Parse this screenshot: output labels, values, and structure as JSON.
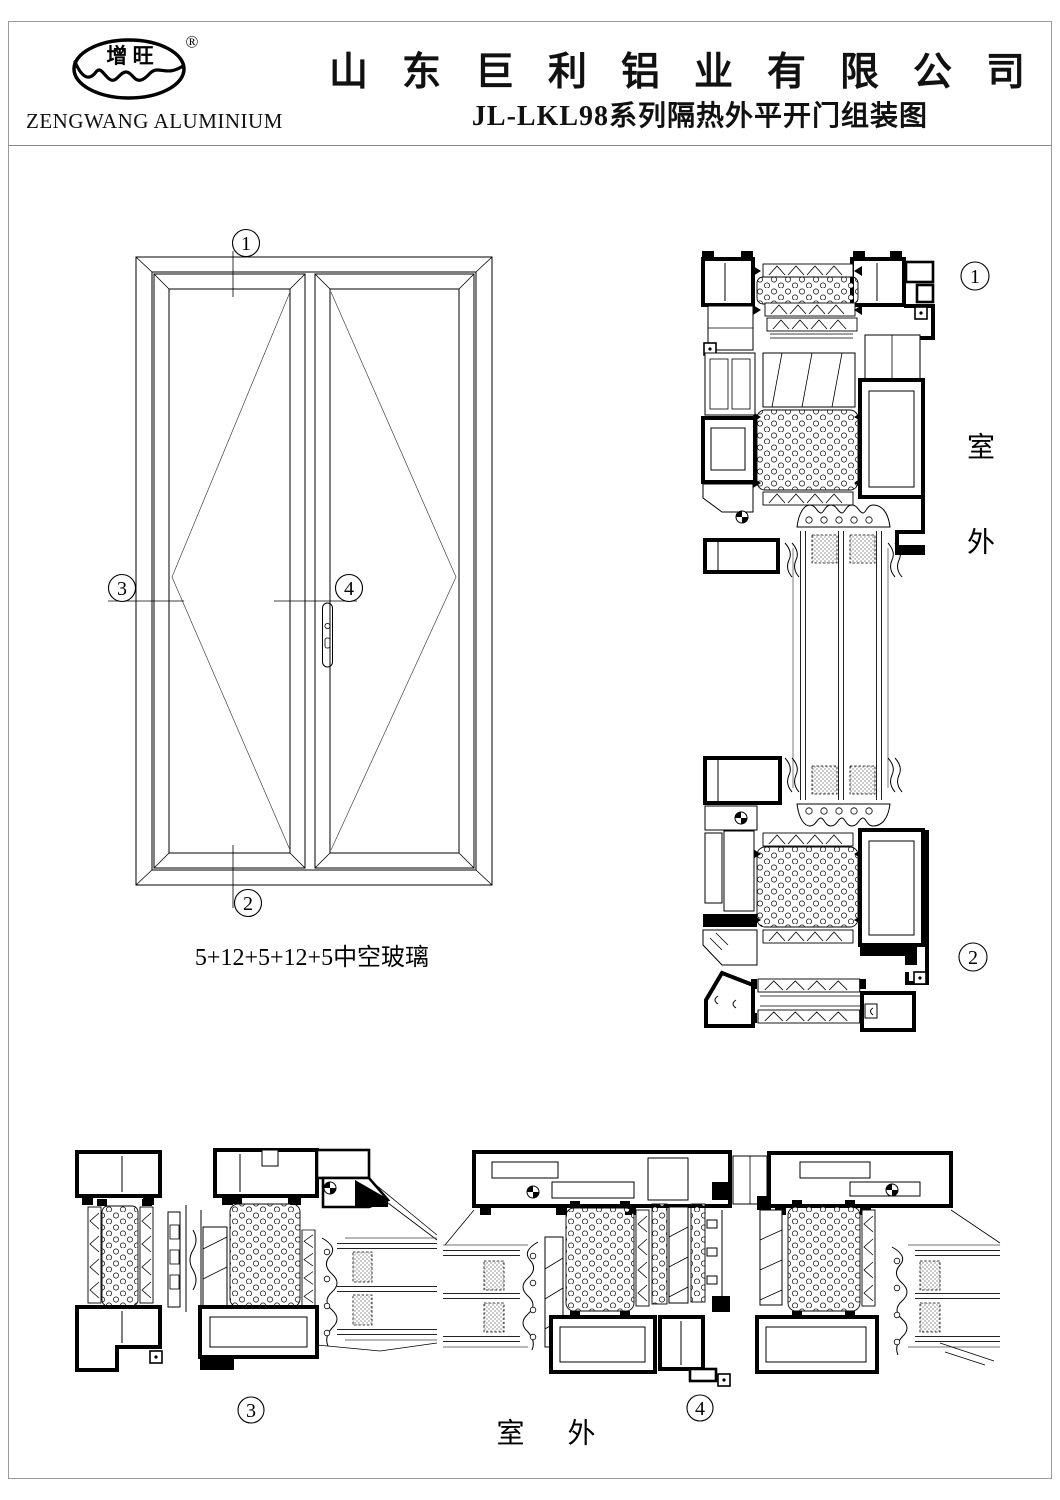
{
  "colors": {
    "ink": "#000000",
    "paper": "#ffffff",
    "page_border": "#9a9a9a"
  },
  "header": {
    "logo": {
      "oval_text": "增 旺",
      "registered_mark": "®",
      "company_en": "ZENGWANG ALUMINIUM"
    },
    "company_cn": "山东巨利铝业有限公司",
    "drawing_title": "JL-LKL98系列隔热外平开门组装图"
  },
  "elevation": {
    "glass_spec": "5+12+5+12+5中空玻璃",
    "callout_1": "1",
    "callout_2": "2",
    "callout_3": "3",
    "callout_4": "4"
  },
  "vertical_section": {
    "callout_top": "1",
    "callout_bottom": "2",
    "outdoor_char_top": "室",
    "outdoor_char_bottom": "外"
  },
  "horizontal_sections": {
    "callout_left": "3",
    "callout_right": "4",
    "outdoor_label": "室 外"
  }
}
